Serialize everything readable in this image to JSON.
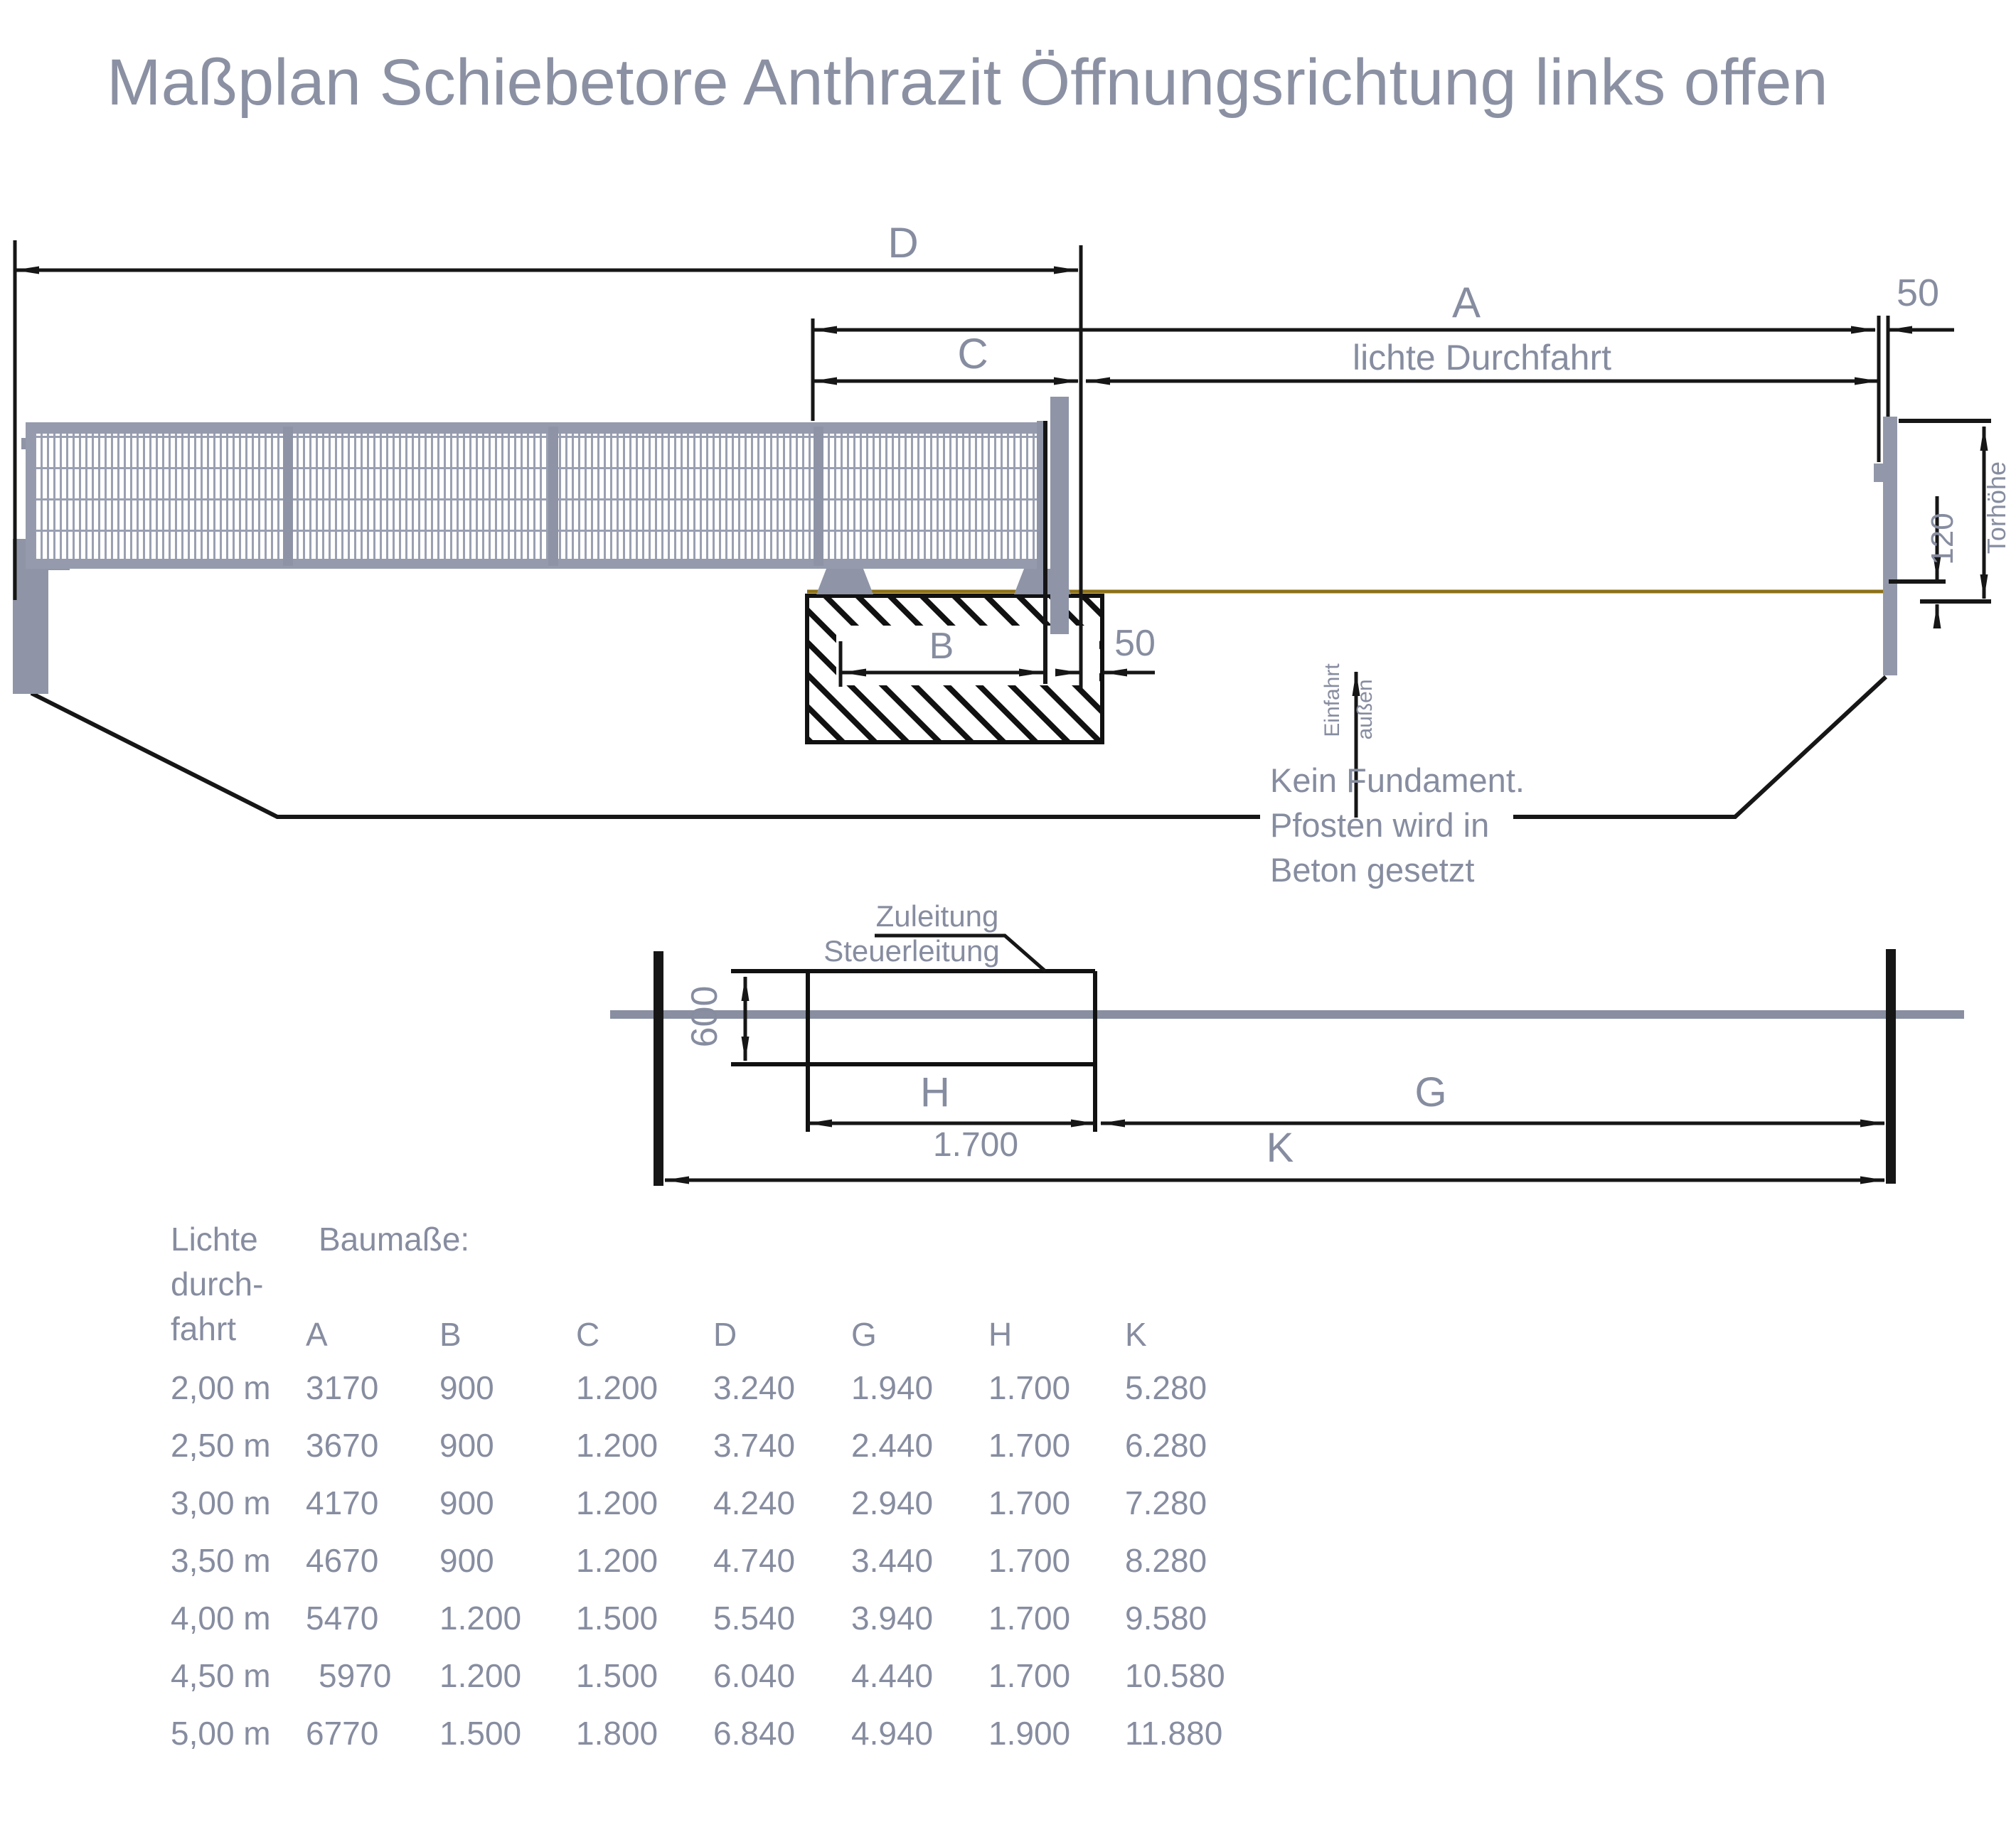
{
  "title": "Maßplan Schiebetore Anthrazit Öffnungsrichtung links offen",
  "colors": {
    "text": "#878da0",
    "line": "#161616",
    "gate": "#959bac",
    "ground": "#8d7118"
  },
  "top_view": {
    "dim_d": "D",
    "dim_a": "A",
    "dim_c": "C",
    "dim_b": "B",
    "clear_passage_label": "lichte Durchfahrt",
    "post_gap_top": "50",
    "gate_foundation_gap": "50",
    "gate_height_label": "Torhöhe",
    "ground_clearance": "120",
    "entry_direction_line1": "Einfahrt",
    "entry_direction_line2": "außen",
    "note_line1": "Kein Fundament.",
    "note_line2": "Pfosten wird in",
    "note_line3": "Beton gesetzt"
  },
  "plan_view": {
    "supply_line_label": "Zuleitung",
    "control_line_label": "Steuerleitung",
    "foundation_depth": "600",
    "dim_h": "H",
    "h_value": "1.700",
    "dim_g": "G",
    "dim_k": "K"
  },
  "table": {
    "row_header_lines": [
      "Lichte",
      "durch-",
      "fahrt"
    ],
    "dims_header": "Baumaße:",
    "columns": [
      "A",
      "B",
      "C",
      "D",
      "G",
      "H",
      "K"
    ],
    "rows": [
      {
        "label": "2,00 m",
        "values": [
          "3170",
          "900",
          "1.200",
          "3.240",
          "1.940",
          "1.700",
          "5.280"
        ]
      },
      {
        "label": "2,50 m",
        "values": [
          "3670",
          "900",
          "1.200",
          "3.740",
          "2.440",
          "1.700",
          "6.280"
        ]
      },
      {
        "label": "3,00 m",
        "values": [
          "4170",
          "900",
          "1.200",
          "4.240",
          "2.940",
          "1.700",
          "7.280"
        ]
      },
      {
        "label": "3,50 m",
        "values": [
          "4670",
          "900",
          "1.200",
          "4.740",
          "3.440",
          "1.700",
          "8.280"
        ]
      },
      {
        "label": "4,00 m",
        "values": [
          "5470",
          "1.200",
          "1.500",
          "5.540",
          "3.940",
          "1.700",
          "9.580"
        ]
      },
      {
        "label": "4,50 m",
        "values": [
          "5970",
          "1.200",
          "1.500",
          "6.040",
          "4.440",
          "1.700",
          "10.580"
        ]
      },
      {
        "label": "5,00 m",
        "values": [
          "6770",
          "1.500",
          "1.800",
          "6.840",
          "4.940",
          "1.900",
          "11.880"
        ]
      }
    ]
  }
}
